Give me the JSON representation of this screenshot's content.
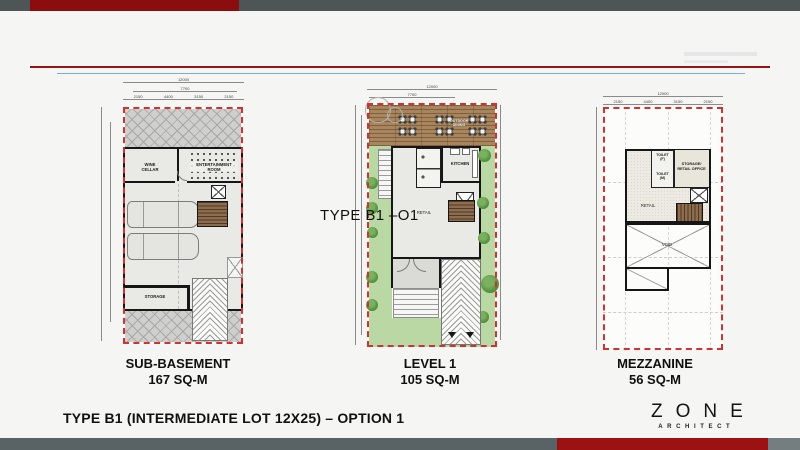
{
  "slide": {
    "watermark": "TYPE B1 –O1",
    "title": "TYPE  B1 (INTERMEDIATE LOT 12X25) – OPTION 1"
  },
  "logo": {
    "name": "ZONE",
    "tagline": "ARCHITECT"
  },
  "plans": [
    {
      "name": "SUB-BASEMENT",
      "area": "167 SQ-M",
      "dims": {
        "total": "12000",
        "building": "7700",
        "segs": [
          "2150",
          "4400",
          "3150",
          "2150"
        ]
      },
      "rooms": {
        "wine_cellar": "WINE\nCELLAR",
        "entertainment": "ENTERTAINMENT\nROOM",
        "storage": "STORAGE"
      }
    },
    {
      "name": "LEVEL 1",
      "area": "105 SQ-M",
      "dims": {
        "total": "12000",
        "building": "7700"
      },
      "rooms": {
        "outdoor": "OUTDOOR\nDINING",
        "kitchen": "KITCHEN",
        "retail": "RETAIL"
      }
    },
    {
      "name": "MEZZANINE",
      "area": "56 SQ-M",
      "dims": {
        "total": "12000",
        "segs": [
          "2150",
          "4400",
          "3150",
          "2150"
        ]
      },
      "rooms": {
        "toilet_f": "TOILET\n(F)",
        "toilet_m": "TOILET\n(M)",
        "storage_office": "STORAGE/\nRETAIL OFFICE",
        "retail": "RETAIL",
        "void": "VOID"
      }
    }
  ]
}
